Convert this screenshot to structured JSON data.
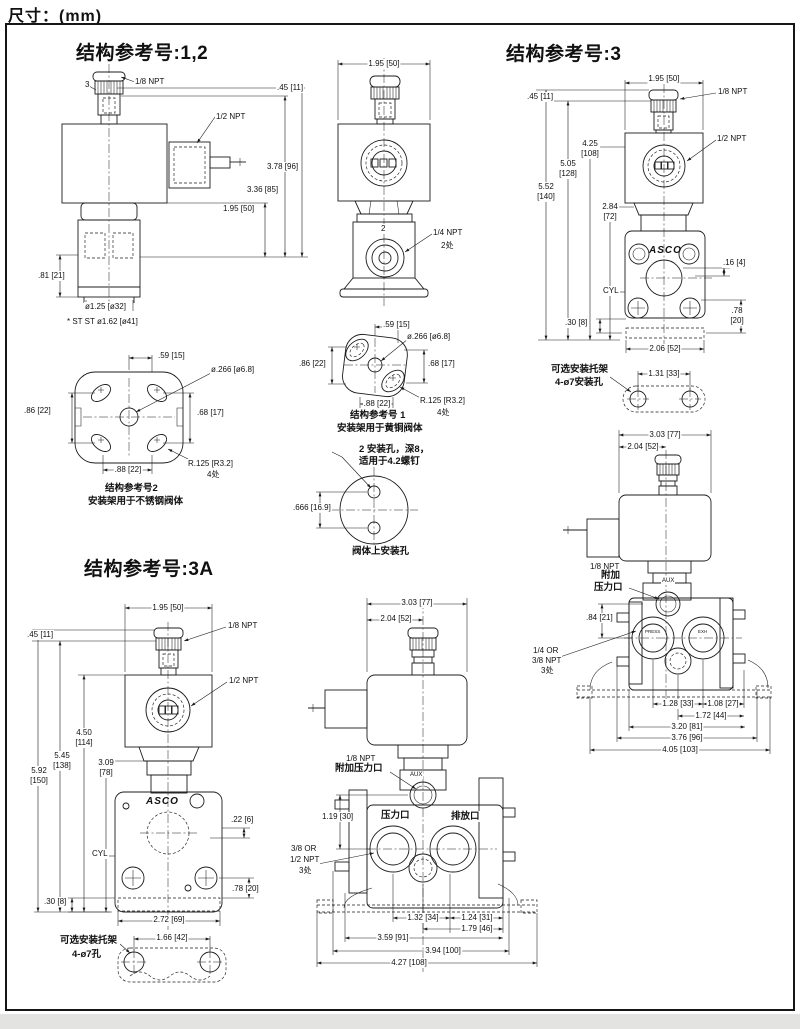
{
  "page": {
    "title": "尺寸：(mm)"
  },
  "ref12": {
    "heading": "结构参考号:1,2",
    "side": {
      "callout_3": "3",
      "npt_18": "1/8 NPT",
      "dim_045": ".45 [11]",
      "npt_12": "1/2 NPT",
      "dim_378": "3.78 [96]",
      "dim_336": "3.36 [85]",
      "dim_195": "1.95 [50]",
      "dim_081": ".81 [21]",
      "dim_dia125": "ø1.25 [ø32]",
      "note_stst": "* ST ST ø1.62 [ø41]"
    },
    "front": {
      "dim_195": "1.95 [50]",
      "callout_2": "2",
      "npt_14": "1/4 NPT",
      "places_2": "2处"
    }
  },
  "bracket_ref2": {
    "dim_059": ".59 [15]",
    "dim_dia266": "ø.266 [ø6.8]",
    "dim_086": ".86 [22]",
    "dim_068": ".68 [17]",
    "dim_088": ".88 [22]",
    "dim_r125": "R.125 [R3.2]",
    "places_4": "4处",
    "caption_line1": "结构参考号2",
    "caption_line2": "安装架用于不锈钢阀体"
  },
  "bracket_ref1": {
    "dim_059": ".59 [15]",
    "dim_dia266": "ø.266 [ø6.8]",
    "dim_086": ".86 [22]",
    "dim_068": ".68 [17]",
    "dim_088": ".88 [22]",
    "dim_r125": "R.125 [R3.2]",
    "places_4": "4处",
    "caption_line1": "结构参考号 1",
    "caption_line2": "安装架用于黄铜阀体"
  },
  "body_holes": {
    "note_line1": "2 安装孔，深8，",
    "note_line2": "适用于4.2螺钉",
    "dim_666": ".666 [16.9]",
    "caption": "阀体上安装孔"
  },
  "ref3": {
    "heading": "结构参考号:3",
    "front": {
      "dim_195": "1.95 [50]",
      "dim_045": ".45 [11]",
      "npt_18": "1/8 NPT",
      "npt_12": "1/2 NPT",
      "dim_425": "4.25\n[108]",
      "dim_505": "5.05\n[128]",
      "dim_552": "5.52\n[140]",
      "dim_284": "2.84\n[72]",
      "logo": "ASCO",
      "dim_016": ".16 [4]",
      "cyl": "CYL",
      "dim_030": ".30 [8]",
      "dim_078": ".78\n[20]",
      "dim_206": "2.06 [52]"
    },
    "bracket": {
      "note_line1": "可选安装托架",
      "note_line2": "4-ø7安装孔",
      "dim_131": "1.31 [33]"
    },
    "side": {
      "dim_303": "3.03 [77]",
      "dim_204": "2.04 [52]",
      "npt_18": "1/8 NPT",
      "note_fujia": "附加",
      "note_yaliko": "压力口",
      "aux": "AUX",
      "dim_084": ".84 [21]",
      "npt_line1": "1/4 OR",
      "npt_line2": "3/8 NPT",
      "places_3": "3处",
      "port_left": "PRESS",
      "port_right": "EXH",
      "dim_128": "1.28 [33]",
      "dim_108": "1.08 [27]",
      "dim_172": "1.72 [44]",
      "dim_320": "3.20 [81]",
      "dim_376": "3.76 [96]",
      "dim_405": "4.05 [103]"
    }
  },
  "ref3a": {
    "heading": "结构参考号:3A",
    "front": {
      "dim_195": "1.95 [50]",
      "dim_045": ".45 [11]",
      "npt_18": "1/8 NPT",
      "npt_12": "1/2 NPT",
      "dim_450": "4.50\n[114]",
      "dim_545": "5.45\n[138]",
      "dim_592": "5.92\n[150]",
      "dim_309": "3.09\n[78]",
      "logo": "ASCO",
      "dim_022": ".22 [6]",
      "cyl": "CYL",
      "dim_078": ".78 [20]",
      "dim_030": ".30 [8]",
      "dim_272": "2.72 [69]"
    },
    "bracket": {
      "note_line1": "可选安装托架",
      "note_line2": "4-ø7孔",
      "dim_166": "1.66 [42]"
    },
    "side": {
      "dim_303": "3.03 [77]",
      "dim_204": "2.04 [52]",
      "npt_18": "1/8 NPT",
      "note_fujia": "附加压力口",
      "aux": "AUX",
      "dim_119": "1.19 [30]",
      "port_pressure": "压力口",
      "port_exhaust": "排放口",
      "npt_line1": "3/8 OR",
      "npt_line2": "1/2 NPT",
      "places_3": "3处",
      "dim_132": "1.32 [34]",
      "dim_124": "1.24 [31]",
      "dim_179": "1.79 [46]",
      "dim_359": "3.59 [91]",
      "dim_394": "3.94 [100]",
      "dim_427": "4.27 [108]"
    }
  }
}
